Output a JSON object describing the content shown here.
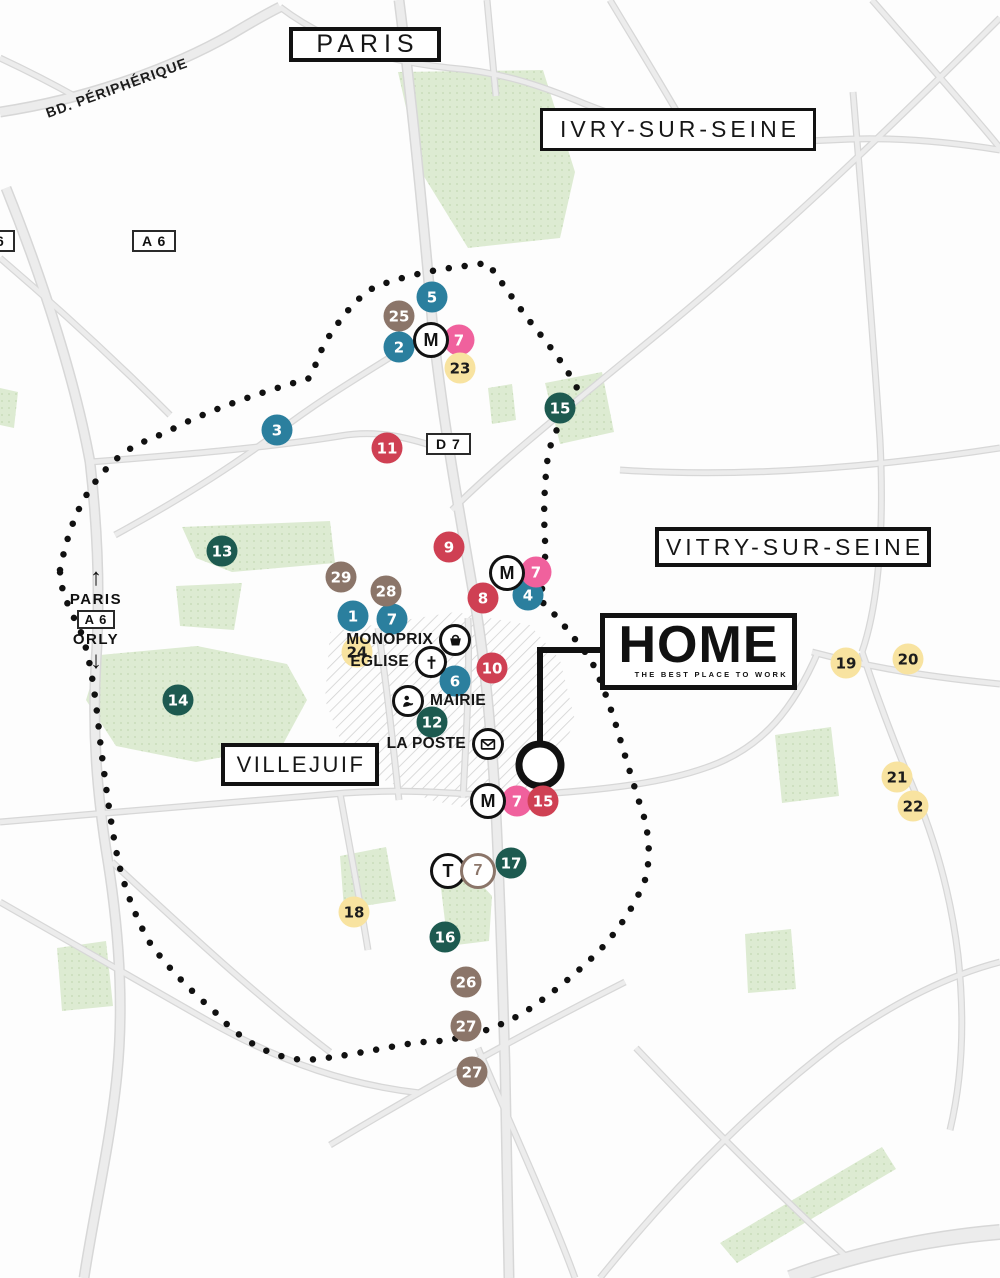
{
  "title_labels": {
    "paris": "PARIS",
    "ivry": "IVRY-SUR-SEINE",
    "vitry": "VITRY-SUR-SEINE",
    "villejuif": "VILLEJUIF"
  },
  "roads": {
    "peripherique": "BD. PÉRIPHÉRIQUE",
    "a6_badge": "A 6",
    "a6_badge_partial": "6",
    "d7_badge": "D 7"
  },
  "direction_sign": {
    "up_arrow": "↑",
    "to_paris": "PARIS",
    "a6": "A 6",
    "to_orly": "ORLY",
    "down_arrow": "↓"
  },
  "home": {
    "title": "HOME",
    "subtitle": "THE BEST PLACE TO WORK"
  },
  "pois": [
    {
      "id": "monoprix",
      "label": "MONOPRIX",
      "icon": "shopping-basket-icon",
      "icon_x": 455,
      "icon_y": 640,
      "label_side": "left"
    },
    {
      "id": "eglise",
      "label": "EGLISE",
      "icon": "church-cross-icon",
      "icon_x": 431,
      "icon_y": 662,
      "label_side": "left"
    },
    {
      "id": "mairie",
      "label": "MAIRIE",
      "icon": "person-icon",
      "icon_x": 408,
      "icon_y": 701,
      "label_side": "right"
    },
    {
      "id": "la-poste",
      "label": "LA POSTE",
      "icon": "envelope-icon",
      "icon_x": 488,
      "icon_y": 744,
      "label_side": "left"
    }
  ],
  "transit_badges": [
    {
      "symbol": "M",
      "type": "metro",
      "x": 431,
      "y": 340
    },
    {
      "symbol": "M",
      "type": "metro",
      "x": 507,
      "y": 573
    },
    {
      "symbol": "M",
      "type": "metro",
      "x": 488,
      "y": 801
    },
    {
      "symbol": "T",
      "type": "tram",
      "x": 448,
      "y": 871
    },
    {
      "symbol": "7",
      "type": "tram-line",
      "x": 478,
      "y": 871
    }
  ],
  "markers": [
    {
      "num": "1",
      "color": "teal",
      "x": 353,
      "y": 616
    },
    {
      "num": "2",
      "color": "teal",
      "x": 399,
      "y": 347
    },
    {
      "num": "3",
      "color": "teal",
      "x": 277,
      "y": 430
    },
    {
      "num": "4",
      "color": "teal",
      "x": 528,
      "y": 595
    },
    {
      "num": "5",
      "color": "teal",
      "x": 432,
      "y": 297
    },
    {
      "num": "6",
      "color": "teal",
      "x": 455,
      "y": 681
    },
    {
      "num": "7",
      "color": "teal",
      "x": 392,
      "y": 619
    },
    {
      "num": "7",
      "color": "pink",
      "x": 459,
      "y": 340
    },
    {
      "num": "7",
      "color": "pink",
      "x": 536,
      "y": 572
    },
    {
      "num": "7",
      "color": "pink",
      "x": 517,
      "y": 801
    },
    {
      "num": "8",
      "color": "red",
      "x": 483,
      "y": 598
    },
    {
      "num": "9",
      "color": "red",
      "x": 449,
      "y": 547
    },
    {
      "num": "10",
      "color": "red",
      "x": 492,
      "y": 668
    },
    {
      "num": "11",
      "color": "red",
      "x": 387,
      "y": 448
    },
    {
      "num": "12",
      "color": "green",
      "x": 432,
      "y": 722
    },
    {
      "num": "13",
      "color": "green",
      "x": 222,
      "y": 551
    },
    {
      "num": "14",
      "color": "green",
      "x": 178,
      "y": 700
    },
    {
      "num": "15",
      "color": "green",
      "x": 560,
      "y": 408
    },
    {
      "num": "15",
      "color": "red",
      "x": 543,
      "y": 801
    },
    {
      "num": "16",
      "color": "green",
      "x": 445,
      "y": 937
    },
    {
      "num": "17",
      "color": "green",
      "x": 511,
      "y": 863
    },
    {
      "num": "18",
      "color": "yellow",
      "x": 354,
      "y": 912
    },
    {
      "num": "19",
      "color": "yellow",
      "x": 846,
      "y": 663
    },
    {
      "num": "20",
      "color": "yellow",
      "x": 908,
      "y": 659
    },
    {
      "num": "21",
      "color": "yellow",
      "x": 897,
      "y": 777
    },
    {
      "num": "22",
      "color": "yellow",
      "x": 913,
      "y": 806
    },
    {
      "num": "23",
      "color": "yellow",
      "x": 460,
      "y": 368
    },
    {
      "num": "24",
      "color": "yellow",
      "x": 357,
      "y": 652
    },
    {
      "num": "25",
      "color": "brown",
      "x": 399,
      "y": 316
    },
    {
      "num": "26",
      "color": "brown",
      "x": 466,
      "y": 982
    },
    {
      "num": "27",
      "color": "brown",
      "x": 466,
      "y": 1026
    },
    {
      "num": "27",
      "color": "brown",
      "x": 472,
      "y": 1072
    },
    {
      "num": "28",
      "color": "brown",
      "x": 386,
      "y": 591
    },
    {
      "num": "29",
      "color": "brown",
      "x": 341,
      "y": 577
    }
  ],
  "colors": {
    "teal": "#2b7f9e",
    "pink": "#f0619d",
    "red": "#cf4053",
    "brown": "#8b7569",
    "dark_green": "#1d5a50",
    "yellow": "#f8e3a0",
    "park": "#ddebd2",
    "road": "#ececec",
    "boundary": "#111111"
  }
}
